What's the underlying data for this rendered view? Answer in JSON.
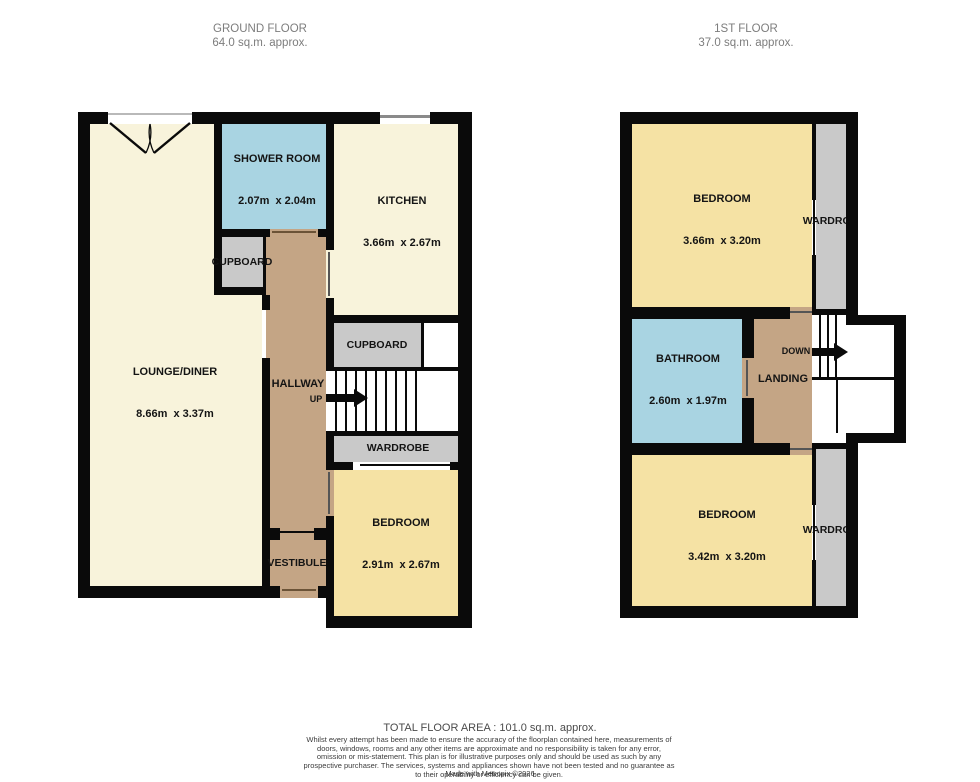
{
  "titles": {
    "ground": {
      "name": "GROUND FLOOR",
      "area": "64.0 sq.m. approx."
    },
    "first": {
      "name": "1ST FLOOR",
      "area": "37.0 sq.m. approx."
    }
  },
  "ground_floor": {
    "lounge_diner": {
      "name": "LOUNGE/DINER",
      "dims": "8.66m  x 3.37m"
    },
    "shower_room": {
      "name": "SHOWER ROOM",
      "dims": "2.07m  x 2.04m"
    },
    "kitchen": {
      "name": "KITCHEN",
      "dims": "3.66m  x 2.67m"
    },
    "cupboard_hall": {
      "name": "CUPBOARD"
    },
    "cupboard_stairs": {
      "name": "CUPBOARD"
    },
    "hallway": {
      "name": "HALLWAY"
    },
    "stairs": {
      "direction": "UP"
    },
    "wardrobe": {
      "name": "WARDROBE"
    },
    "bedroom": {
      "name": "BEDROOM",
      "dims": "2.91m  x 2.67m"
    },
    "vestibule": {
      "name": "VESTIBULE"
    }
  },
  "first_floor": {
    "bedroom_front": {
      "name": "BEDROOM",
      "dims": "3.66m  x 3.20m"
    },
    "wardrobe_front": {
      "name": "WARDROBE"
    },
    "bathroom": {
      "name": "BATHROOM",
      "dims": "2.60m  x 1.97m"
    },
    "landing": {
      "name": "LANDING"
    },
    "stairs": {
      "direction": "DOWN"
    },
    "bedroom_back": {
      "name": "BEDROOM",
      "dims": "3.42m  x 3.20m"
    },
    "wardrobe_back": {
      "name": "WARDROBE"
    }
  },
  "footer": {
    "total_area": "TOTAL FLOOR AREA : 101.0 sq.m. approx.",
    "disclaimer": "Whilst every attempt has been made to ensure the accuracy of the floorplan contained here, measurements of doors, windows, rooms and any other items are approximate and no responsibility is taken for any error, omission or mis-statement. This plan is for illustrative purposes only and should be used as such by any prospective purchaser. The services, systems and appliances shown have not been tested and no guarantee as to their operability or efficiency can be given.",
    "credit": "Made with Metropix ©2026"
  },
  "colors": {
    "wall": "#0a0a0a",
    "room_cream": "#F8F3DB",
    "room_yellow": "#F5E2A4",
    "room_blue": "#A9D4E2",
    "room_brown": "#C4A585",
    "room_gray": "#C9C9C9",
    "title_text": "#7d7d7d",
    "footer_text": "#3c3c3c"
  }
}
